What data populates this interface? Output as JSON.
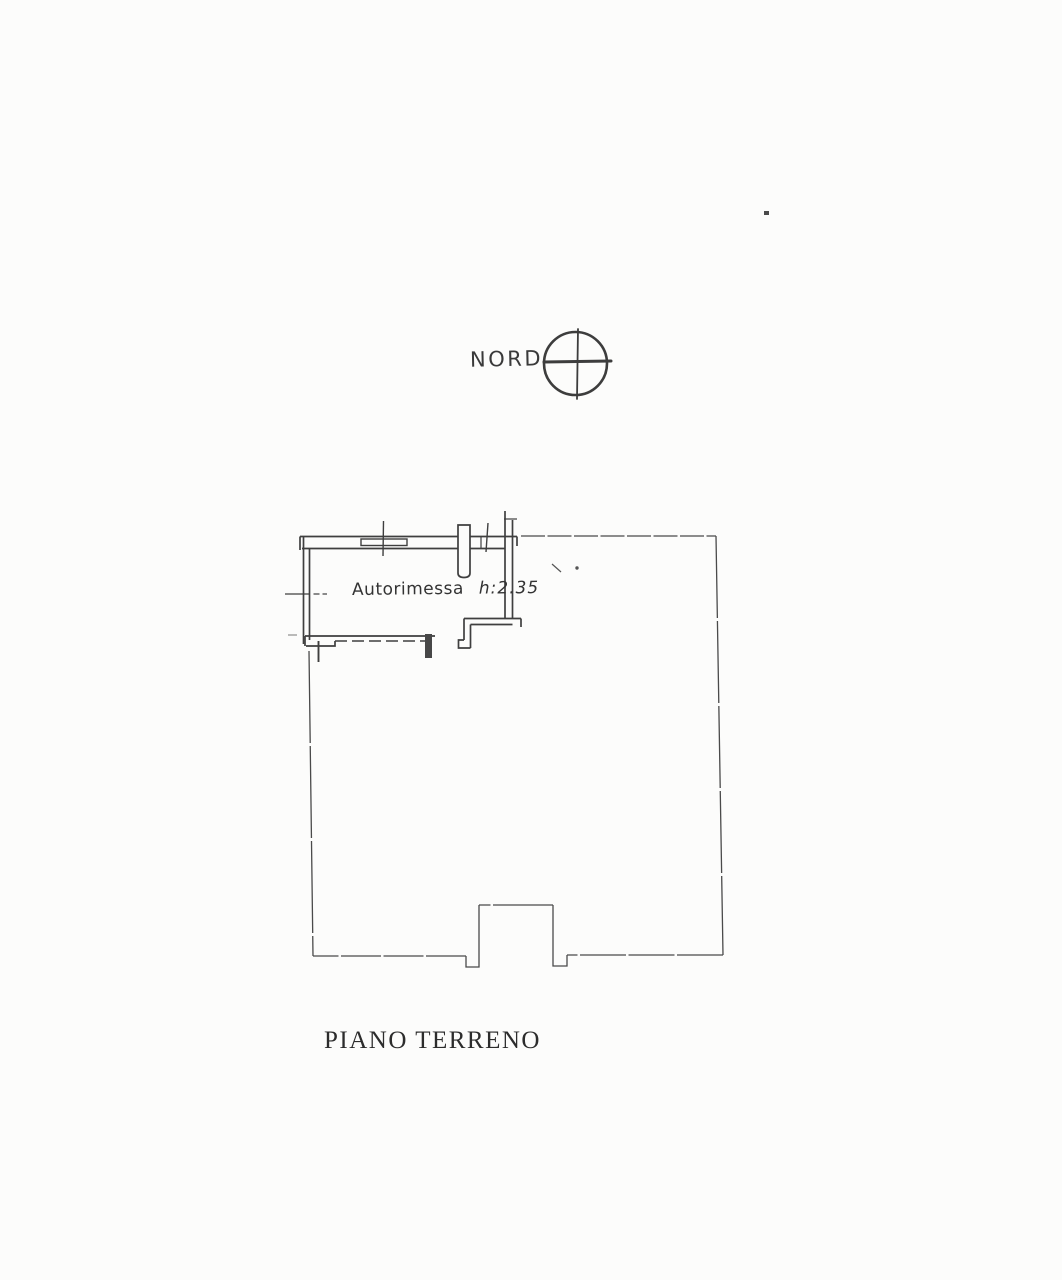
{
  "page": {
    "background": "#fcfcfb",
    "ink_color": "#3d3d3d",
    "boundary_color": "#4a4a4a"
  },
  "compass": {
    "label": "NORD"
  },
  "plan": {
    "room_label": "Autorimessa",
    "room_height_label": "h:2.35",
    "floor_label": "PIANO  TERRENO"
  }
}
